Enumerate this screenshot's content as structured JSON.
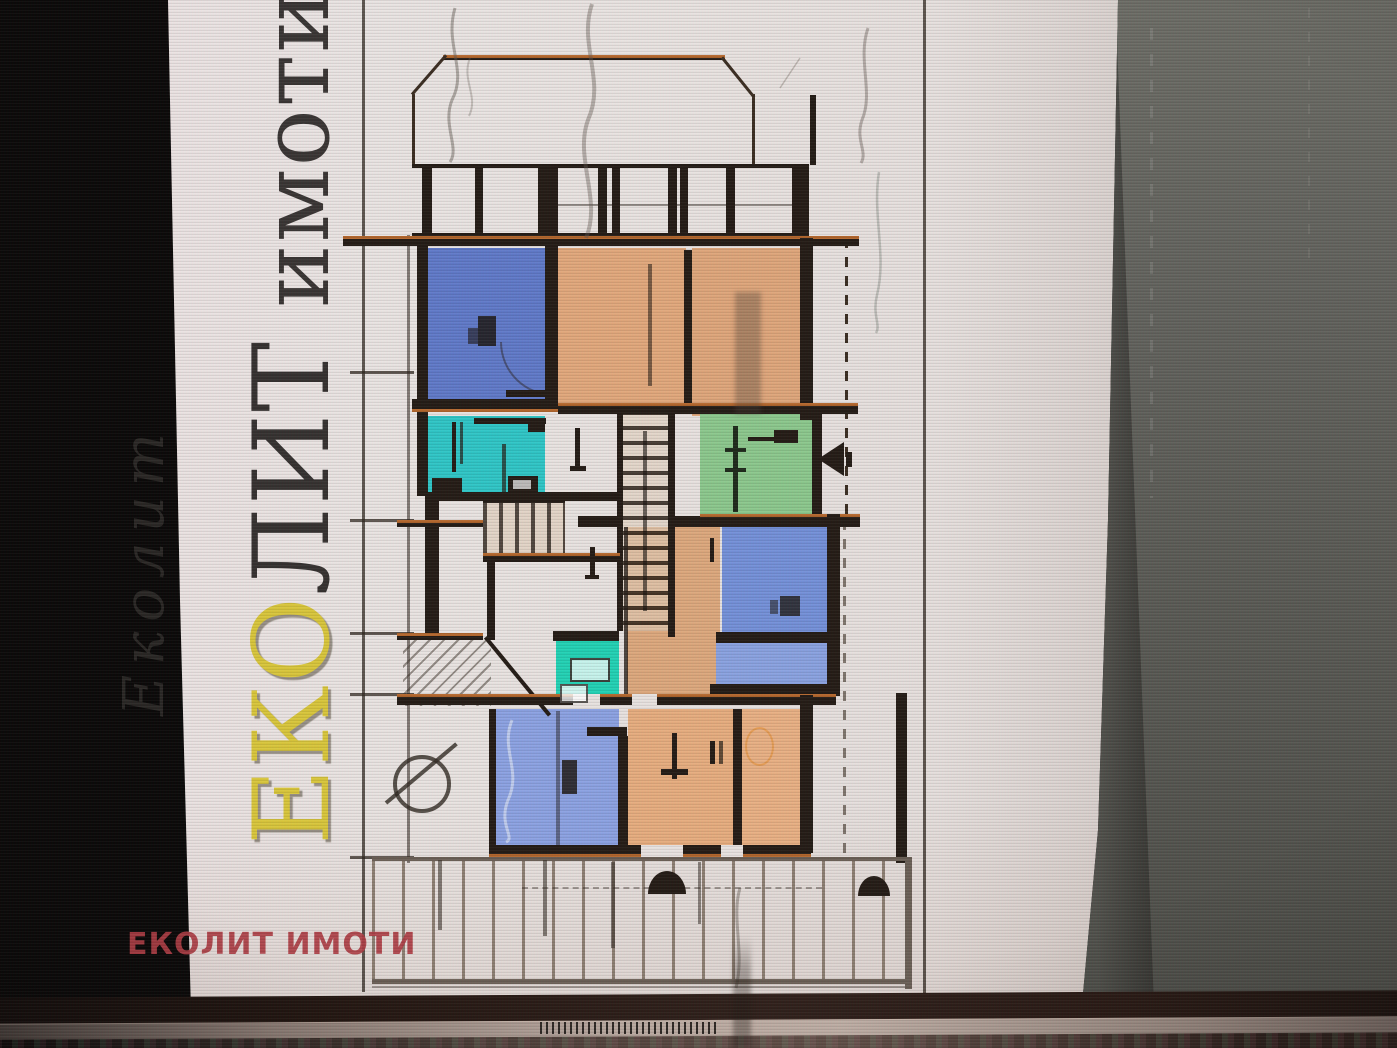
{
  "meta": {
    "description": "Photograph of a screen showing an apartment floor plan with real-estate agency watermarks"
  },
  "watermark": {
    "vertical": {
      "brand_primary": "ЕКО",
      "brand_secondary": "ЛИТ",
      "brand_suffix": " имоти"
    },
    "ghost": "Еколит",
    "footer": "ЕКОЛИТ ИМОТИ"
  },
  "colors": {
    "gold": "#d9c63a",
    "dark_letter": "#262220",
    "red_watermark": "#ae3d44",
    "page_bg": "#e9e3e0",
    "black_bg": "#0a0807",
    "side_panel": "#5e5e57",
    "wall": "#241b14",
    "wall_accent": "#b4672c",
    "room_blue_a": "#6079c8",
    "room_orange_b": "#e2a87b",
    "room_orange_c": "#dfa67a",
    "room_teal": "#2fc6c6",
    "room_green": "#8cc88c",
    "room_blue_d": "#7490d8",
    "room_blue_e": "#8aa2e0",
    "room_teal2": "#22d2b4",
    "room_blue_f": "#8ca2e2",
    "room_orange_g": "#e7ad7e",
    "room_orange_h": "#e9b083",
    "room_orange_cor": "#dda87c",
    "railing": "#857668"
  }
}
